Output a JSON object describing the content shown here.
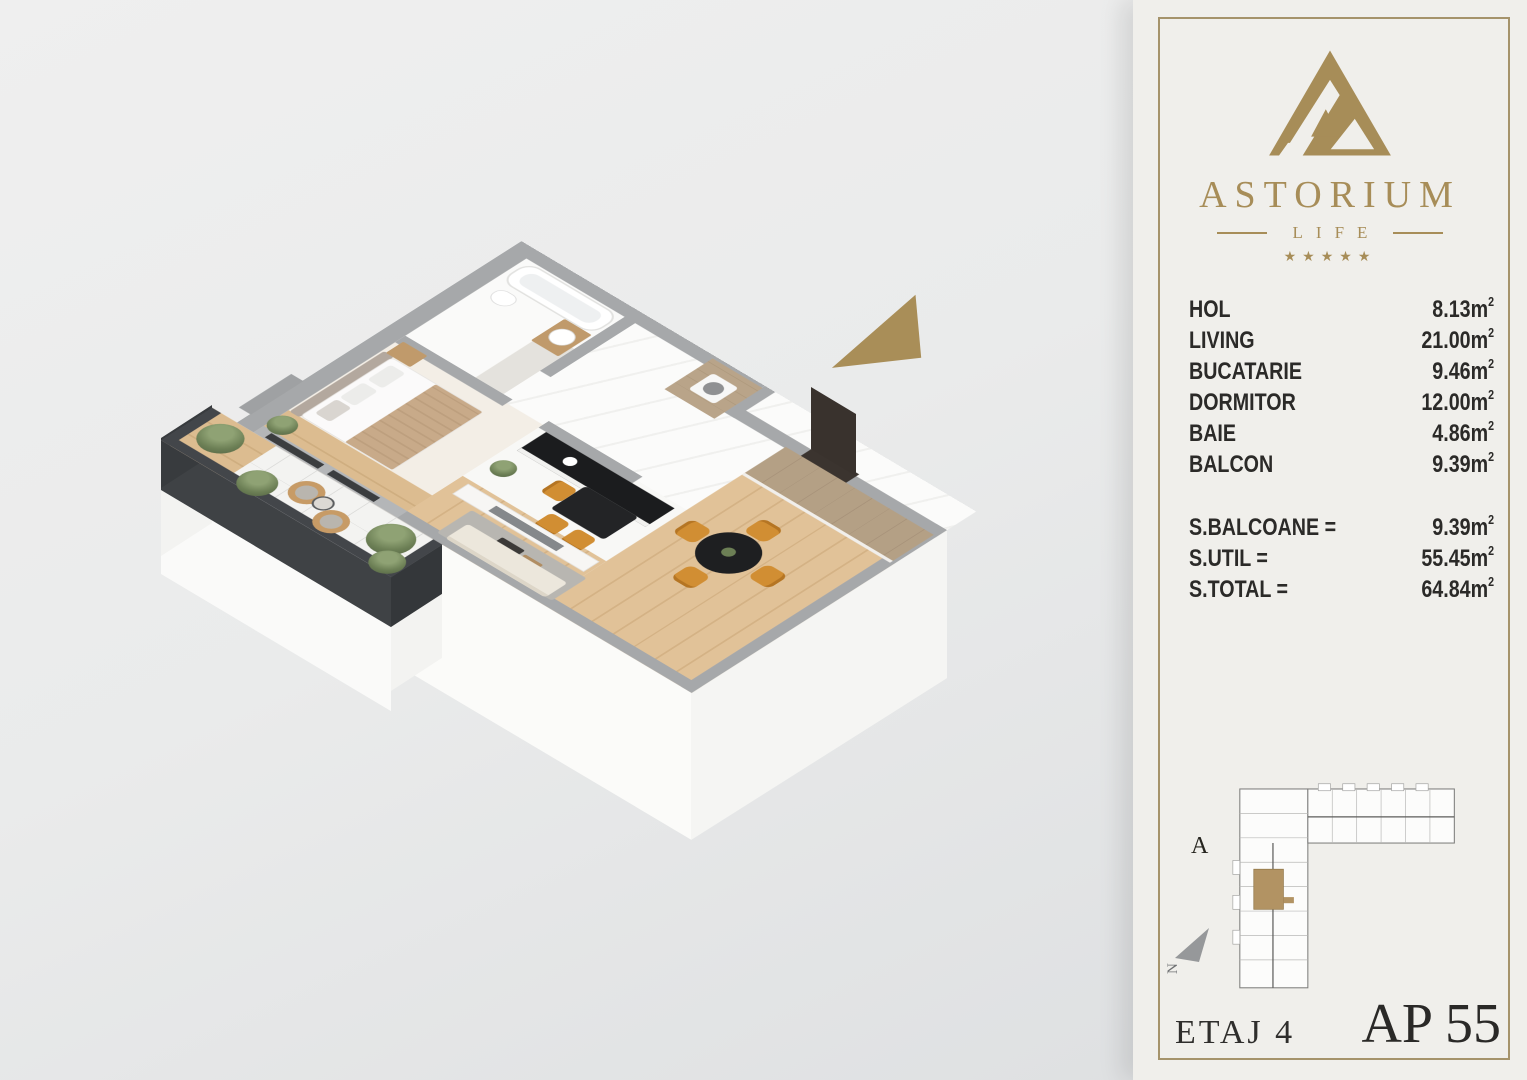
{
  "brand": {
    "name": "ASTORIUM",
    "subtitle": "LIFE",
    "stars": "★★★★★"
  },
  "areas": {
    "rooms": [
      {
        "label": "HOL",
        "value": "8.13"
      },
      {
        "label": "LIVING",
        "value": "21.00"
      },
      {
        "label": "BUCATARIE",
        "value": "9.46"
      },
      {
        "label": "DORMITOR",
        "value": "12.00"
      },
      {
        "label": "BAIE",
        "value": "4.86"
      },
      {
        "label": "BALCON",
        "value": "9.39"
      }
    ],
    "totals": [
      {
        "label": "S.BALCOANE =",
        "value": "9.39"
      },
      {
        "label": "S.UTIL =",
        "value": "55.45"
      },
      {
        "label": "S.TOTAL =",
        "value": "64.84"
      }
    ],
    "unit": {
      "symbol": "m",
      "exp": "2"
    }
  },
  "footer": {
    "floor": "ETAJ 4",
    "apartment": "AP 55"
  },
  "site_plan": {
    "block": "A",
    "compass": "N"
  },
  "colors": {
    "gold": "#a78d58",
    "panel": "#f0efeb",
    "ink": "#2b2a28",
    "wall_top": "#a6a8aa",
    "balcony_wall": "#3f4245",
    "chair_orange": "#d18e33",
    "wood": "#b5a083"
  }
}
